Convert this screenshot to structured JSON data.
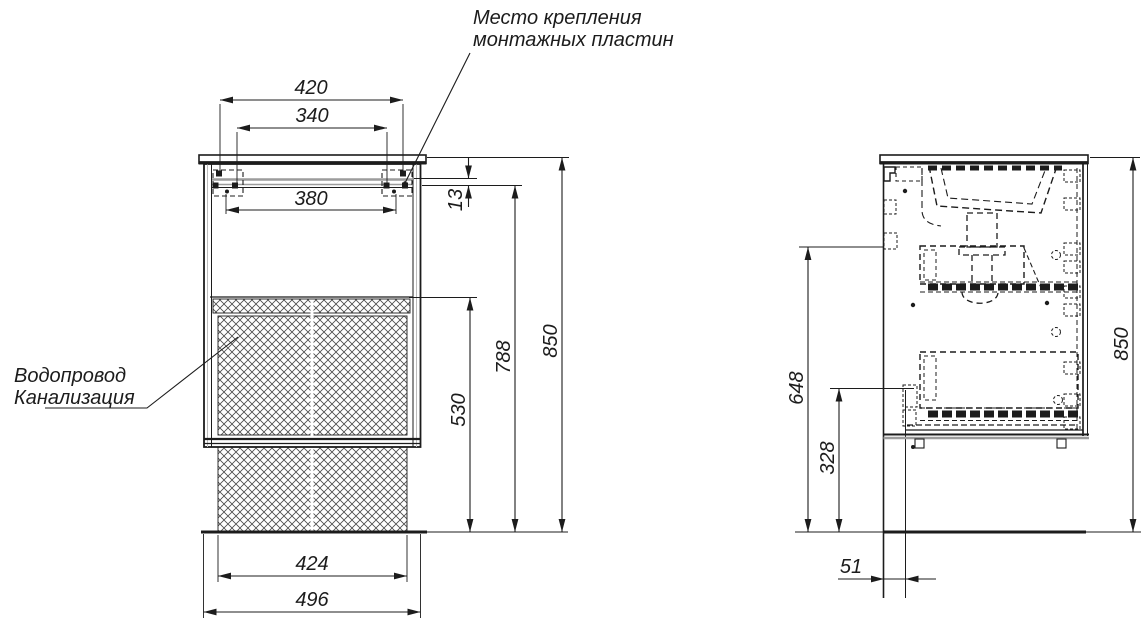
{
  "drawing_title": "vanity-cabinet-installation-drawing",
  "callouts": {
    "mounting": {
      "line1": "Место крепления",
      "line2": "монтажных пластин"
    },
    "plumbing": {
      "line1": "Водопровод",
      "line2": "Канализация"
    }
  },
  "front_view": {
    "dims": {
      "d420": "420",
      "d340": "340",
      "d380": "380",
      "d13": "13",
      "d530": "530",
      "d788": "788",
      "d850": "850",
      "d424": "424",
      "d496": "496"
    }
  },
  "side_view": {
    "dims": {
      "d648": "648",
      "d328": "328",
      "d51": "51",
      "d850": "850"
    }
  },
  "colors": {
    "line": "#1c1c1c",
    "gray_rail": "#9c9c9c",
    "background": "#ffffff"
  }
}
